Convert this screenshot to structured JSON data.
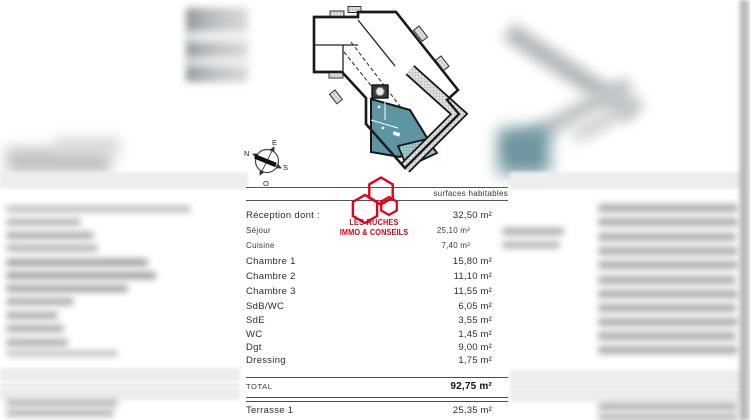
{
  "document": {
    "type": "floor-plan-surface-sheet",
    "accent_colors": {
      "plan_highlight": "#5d95a3",
      "plan_terrace_hatch": "#a9cad1",
      "plan_walls": "#1a1a1a",
      "logo_red": "#e2001a"
    }
  },
  "logo": {
    "line1": "LES RUCHES",
    "line2": "IMMO & CONSEILS"
  },
  "compass": {
    "labels": {
      "top": "E",
      "left": "N",
      "right": "S",
      "bottom": "O"
    }
  },
  "table": {
    "header": "surfaces habitables",
    "rows": [
      {
        "label": "Réception dont :",
        "value": "32,50 m²",
        "style": "main"
      },
      {
        "label": "Séjour",
        "value": "25,10 m²",
        "style": "sub"
      },
      {
        "label": "Cuisine",
        "value": "7,40 m²",
        "style": "sub"
      },
      {
        "label": "Chambre 1",
        "value": "15,80 m²",
        "style": "main"
      },
      {
        "label": "Chambre 2",
        "value": "11,10 m²",
        "style": "main"
      },
      {
        "label": "Chambre 3",
        "value": "11,55 m²",
        "style": "main"
      },
      {
        "label": "SdB/WC",
        "value": "6,05 m²",
        "style": "main"
      },
      {
        "label": "SdE",
        "value": "3,55 m²",
        "style": "main"
      },
      {
        "label": "WC",
        "value": "1,45 m²",
        "style": "main"
      },
      {
        "label": "Dgt",
        "value": "9,00 m²",
        "style": "main"
      },
      {
        "label": "Dressing",
        "value": "1,75 m²",
        "style": "main"
      }
    ],
    "total": {
      "label": "TOTAL",
      "value": "92,75 m²"
    },
    "terrace": {
      "label": "Terrasse 1",
      "value": "25,35 m²"
    }
  }
}
